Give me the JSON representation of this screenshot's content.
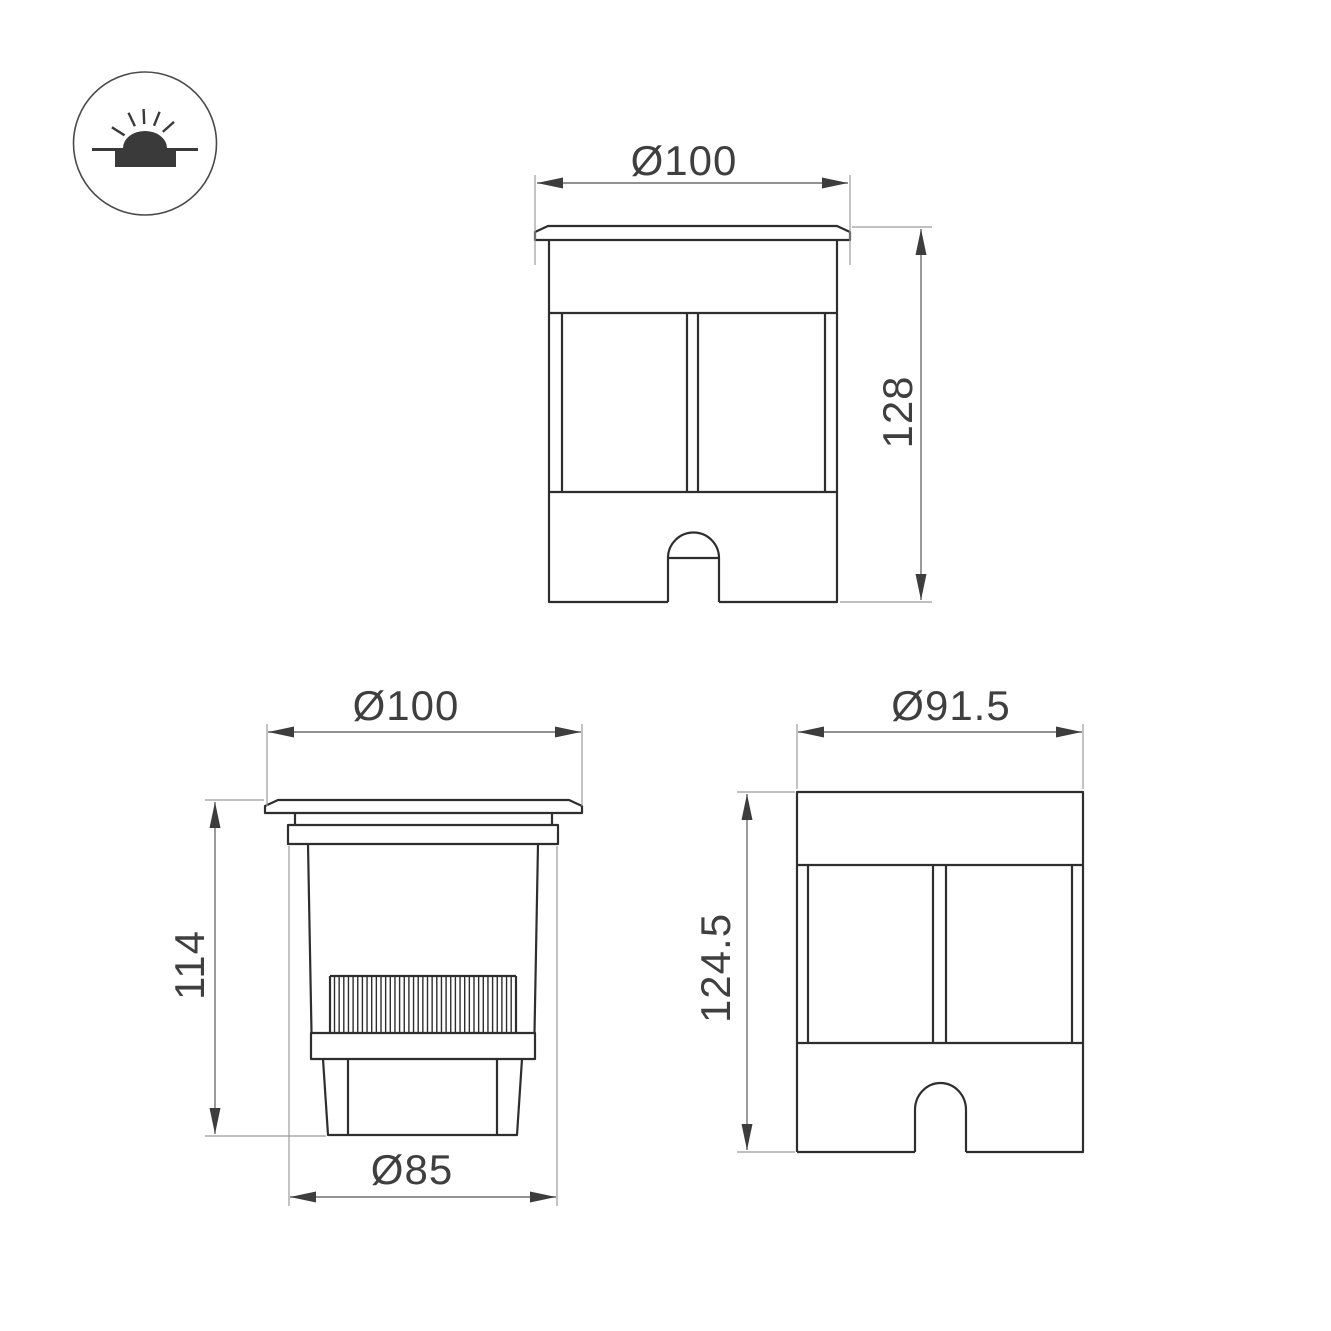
{
  "drawing": {
    "title": "recessed-ground-luminaire-dimension-drawing",
    "colors": {
      "background": "#ffffff",
      "object_line": "#2e2e2e",
      "dimension_line": "#6e6e6e",
      "extension_line": "#9b9b9b",
      "arrow": "#3d3d3d",
      "text": "#3f3f3f"
    },
    "icon": {
      "name": "recessed-ground-light-symbol"
    },
    "views": {
      "front": {
        "diameter": "Ø100",
        "height": "128"
      },
      "side": {
        "diameter_top": "Ø100",
        "height": "114",
        "diameter_bottom": "Ø85"
      },
      "back": {
        "diameter": "Ø91.5",
        "height": "124.5"
      }
    }
  }
}
